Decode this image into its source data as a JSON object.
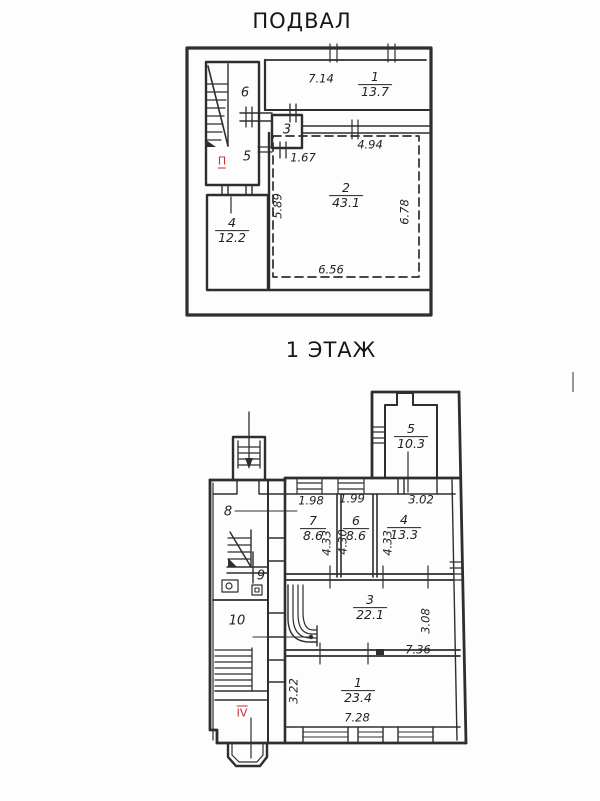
{
  "colors": {
    "ink": "#2e2e2e",
    "red": "#c43131",
    "paper": "#fdfdfd"
  },
  "basement": {
    "title": "ПОДВАЛ",
    "red_mark": "П",
    "rooms": {
      "r1": {
        "num": "1",
        "area": "13.7"
      },
      "r2": {
        "num": "2",
        "area": "43.1"
      },
      "r3": {
        "num": "3"
      },
      "r4": {
        "num": "4",
        "area": "12.2"
      },
      "r5": {
        "num": "5"
      },
      "r6": {
        "num": "6"
      }
    },
    "dims": {
      "room1_width": "7.14",
      "door": "1.67",
      "room2_top": "4.94",
      "room2_left": "5.89",
      "room2_right": "6.78",
      "room2_bottom": "6.56"
    }
  },
  "floor1": {
    "title": "1 ЭТАЖ",
    "red_mark": "IV",
    "rooms": {
      "r1": {
        "num": "1",
        "area": "23.4"
      },
      "r3": {
        "num": "3",
        "area": "22.1"
      },
      "r4": {
        "num": "4",
        "area": "13.3"
      },
      "r5": {
        "num": "5",
        "area": "10.3"
      },
      "r6": {
        "num": "6",
        "area": "8.6"
      },
      "r7": {
        "num": "7",
        "area": "8.6"
      },
      "r8": {
        "num": "8"
      },
      "r9": {
        "num": "9"
      },
      "r10": {
        "num": "10"
      }
    },
    "dims": {
      "r7_width": "1.98",
      "r6_width": "1.99",
      "r4_width": "3.02",
      "r7_depth": "4.33",
      "r6_depth": "4.30",
      "r4_depth": "4.33",
      "r3_right": "3.08",
      "r3_bottom": "7.36",
      "r1_left": "3.22",
      "r1_bottom": "7.28"
    }
  }
}
